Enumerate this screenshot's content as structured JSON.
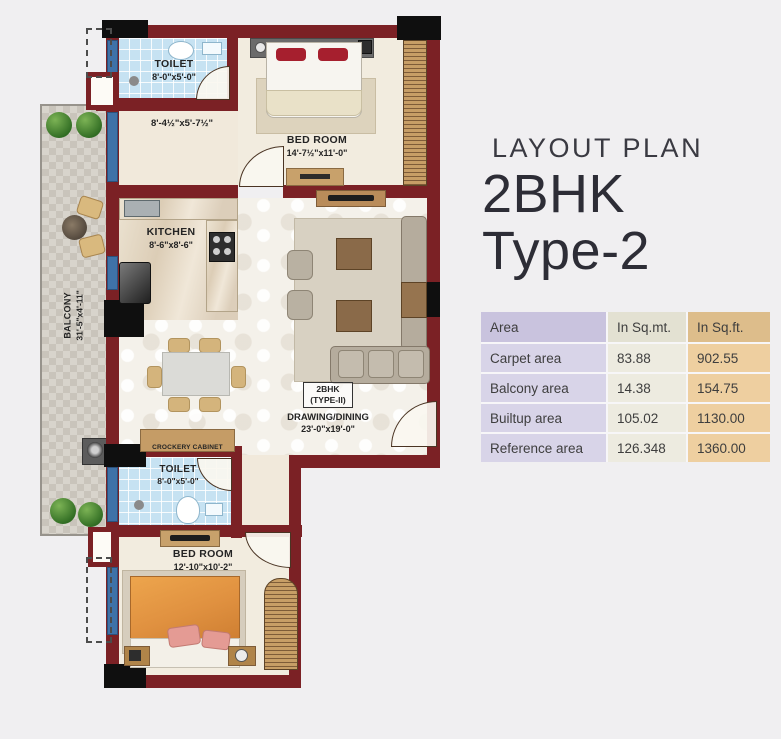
{
  "title_block": {
    "kicker": "LAYOUT PLAN",
    "heading_line1": "2BHK",
    "heading_line2": "Type-2"
  },
  "area_table": {
    "headers": [
      "Area",
      "In Sq.mt.",
      "In Sq.ft."
    ],
    "rows": [
      {
        "area": "Carpet area",
        "sqmt": "83.88",
        "sqft": "902.55"
      },
      {
        "area": "Balcony area",
        "sqmt": "14.38",
        "sqft": "154.75"
      },
      {
        "area": "Builtup area",
        "sqmt": "105.02",
        "sqft": "1130.00"
      },
      {
        "area": "Reference area",
        "sqmt": "126.348",
        "sqft": "1360.00"
      }
    ]
  },
  "plan": {
    "toilet_top": {
      "name": "TOILET",
      "dim": "8'-0\"x5'-0\""
    },
    "passage_dim": "8'-4½\"x5'-7½\"",
    "bedroom_top": {
      "name": "BED ROOM",
      "dim": "14'-7½\"x11'-0\""
    },
    "kitchen": {
      "name": "KITCHEN",
      "dim": "8'-6\"x8'-6\""
    },
    "balcony": {
      "name": "BALCONY",
      "dim": "31'-5\"x4'-11\""
    },
    "unit_tag": {
      "line1": "2BHK",
      "line2": "(TYPE-II)"
    },
    "drawing_dining": {
      "name": "DRAWING/DINING",
      "dim": "23'-0\"x19'-0\""
    },
    "crockery_cabinet": "CROCKERY CABINET",
    "toilet_bottom": {
      "name": "TOILET",
      "dim": "8'-0\"x5'-0\""
    },
    "bedroom_bottom": {
      "name": "BED ROOM",
      "dim": "12'-10\"x10'-2\""
    }
  },
  "colors": {
    "wall": "#7b2125",
    "window_blue": "#3f72a8",
    "toilet_tile": "#c6e2f2",
    "table_lavender": "#c9c3de",
    "table_sage": "#e3e1d2",
    "table_tan": "#ddbd8b"
  }
}
